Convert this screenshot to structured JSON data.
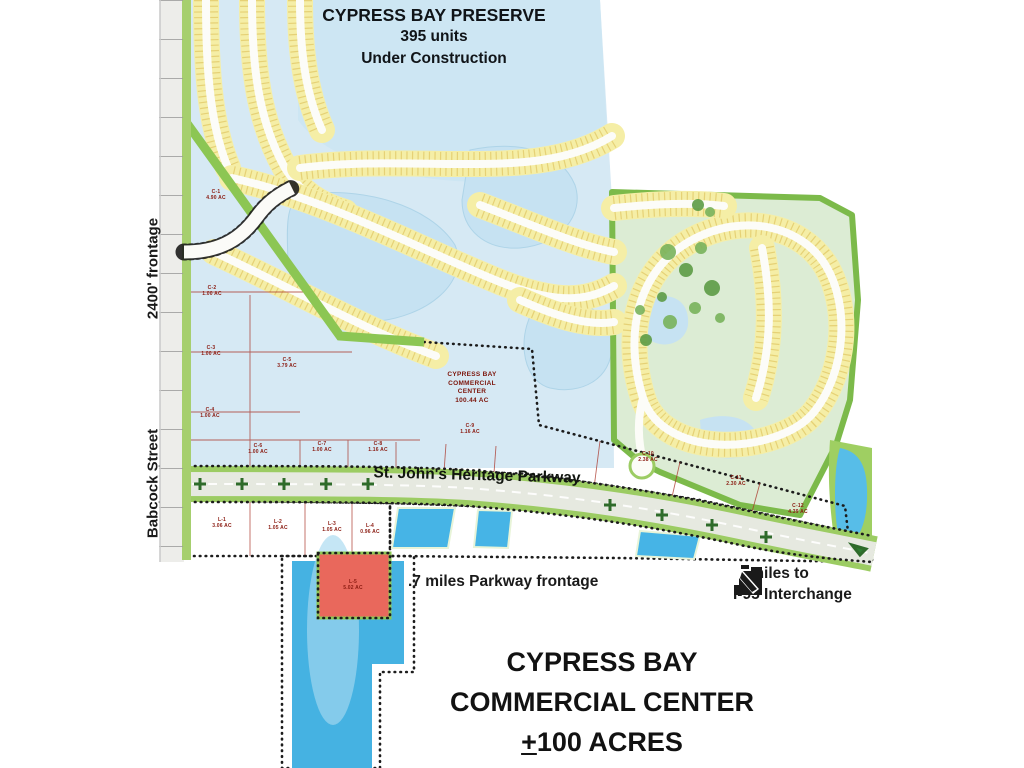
{
  "map_title": {
    "line1": "CYPRESS BAY PRESERVE",
    "line2": "395 units",
    "line3": "Under Construction"
  },
  "street_labels": {
    "frontage": "2400' frontage",
    "babcock": "Babcock Street",
    "parkway": "St. John's Heritage Parkway"
  },
  "annotations": {
    "parkway_frontage": ".7 miles Parkway frontage",
    "i95_line1": ".6 miles to",
    "i95_line2": "I-95 Interchange"
  },
  "footer_title": {
    "line1": "CYPRESS BAY",
    "line2": "COMMERCIAL CENTER",
    "line3_plus": "+",
    "line3_rest": "100 ACRES"
  },
  "center_parcel_label": {
    "line1": "CYPRESS BAY",
    "line2": "COMMERCIAL",
    "line3": "CENTER",
    "line4": "100.44 AC"
  },
  "parcels": [
    {
      "id": "C-1",
      "acres": "4.90 AC",
      "x": 216,
      "y": 196
    },
    {
      "id": "C-2",
      "acres": "1.00 AC",
      "x": 212,
      "y": 292
    },
    {
      "id": "C-3",
      "acres": "1.00 AC",
      "x": 211,
      "y": 352
    },
    {
      "id": "C-4",
      "acres": "1.00 AC",
      "x": 210,
      "y": 414
    },
    {
      "id": "C-5",
      "acres": "3.79 AC",
      "x": 287,
      "y": 364
    },
    {
      "id": "C-6",
      "acres": "1.00 AC",
      "x": 258,
      "y": 450
    },
    {
      "id": "C-7",
      "acres": "1.00 AC",
      "x": 322,
      "y": 448
    },
    {
      "id": "C-8",
      "acres": "1.16 AC",
      "x": 378,
      "y": 448
    },
    {
      "id": "C-9",
      "acres": "1.16 AC",
      "x": 470,
      "y": 430
    },
    {
      "id": "C-10",
      "acres": "2.38 AC",
      "x": 648,
      "y": 458
    },
    {
      "id": "C-11",
      "acres": "2.30 AC",
      "x": 736,
      "y": 482
    },
    {
      "id": "C-12",
      "acres": "4.39 AC",
      "x": 798,
      "y": 510
    },
    {
      "id": "L-1",
      "acres": "3.06 AC",
      "x": 222,
      "y": 524
    },
    {
      "id": "L-2",
      "acres": "1.05 AC",
      "x": 278,
      "y": 526
    },
    {
      "id": "L-3",
      "acres": "1.05 AC",
      "x": 332,
      "y": 528
    },
    {
      "id": "L-4",
      "acres": "0.96 AC",
      "x": 370,
      "y": 530
    },
    {
      "id": "L-5",
      "acres": "5.02 AC",
      "x": 353,
      "y": 586
    }
  ],
  "colors": {
    "parcel_red": "#e9685c",
    "residential_yellow": "#f5eea6",
    "water_light": "#cde6f3",
    "water_bright": "#46b4e6",
    "buffer_green": "#8cc653",
    "road_white": "#fcfcf8",
    "text_black": "#161616",
    "parcel_text": "#8a1a10"
  }
}
